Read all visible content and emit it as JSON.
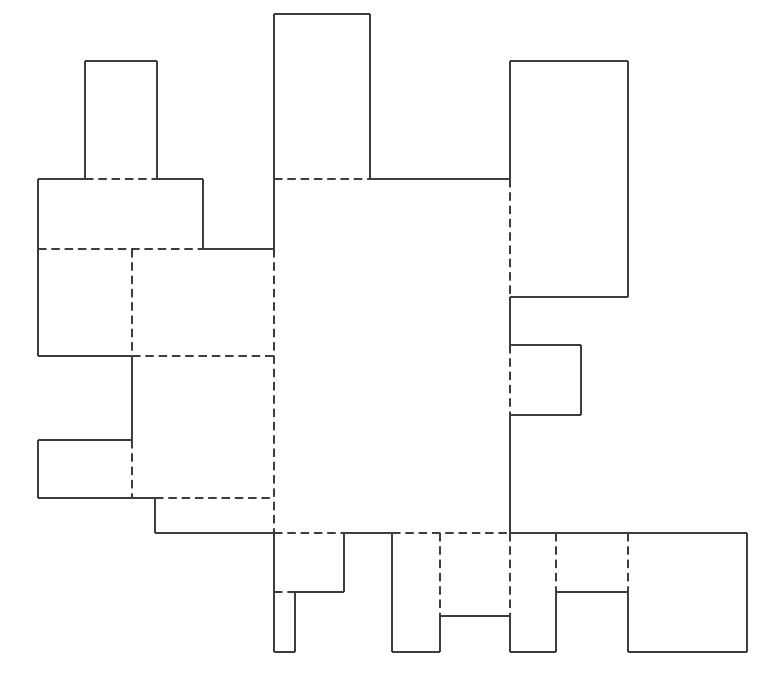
{
  "figure": {
    "title": "box-net-dieline",
    "type": "line-diagram",
    "canvas": {
      "width": 768,
      "height": 685,
      "background": "#ffffff"
    },
    "style": {
      "line_color": "#3d3d3d",
      "line_width": 2,
      "dash_pattern": "8.5 4.8"
    },
    "cut_lines": [
      [
        38,
        179,
        85,
        179
      ],
      [
        85,
        179,
        85,
        61
      ],
      [
        85,
        61,
        157,
        61
      ],
      [
        157,
        61,
        157,
        179
      ],
      [
        157,
        179,
        203,
        179
      ],
      [
        203,
        179,
        203,
        249
      ],
      [
        203,
        249,
        274,
        249
      ],
      [
        274,
        249,
        274,
        14
      ],
      [
        274,
        14,
        370,
        14
      ],
      [
        370,
        14,
        370,
        179
      ],
      [
        370,
        179,
        510,
        179
      ],
      [
        510,
        179,
        510,
        61
      ],
      [
        510,
        61,
        628,
        61
      ],
      [
        628,
        61,
        628,
        297
      ],
      [
        628,
        297,
        510,
        297
      ],
      [
        510,
        297,
        510,
        345
      ],
      [
        510,
        345,
        581,
        345
      ],
      [
        581,
        345,
        581,
        415
      ],
      [
        581,
        415,
        510,
        415
      ],
      [
        510,
        415,
        510,
        533
      ],
      [
        510,
        533,
        747,
        533
      ],
      [
        747,
        533,
        747,
        652
      ],
      [
        747,
        652,
        628,
        652
      ],
      [
        628,
        652,
        628,
        592
      ],
      [
        628,
        592,
        556,
        592
      ],
      [
        556,
        592,
        556,
        652
      ],
      [
        556,
        652,
        510,
        652
      ],
      [
        510,
        652,
        510,
        616
      ],
      [
        510,
        616,
        440,
        616
      ],
      [
        440,
        616,
        440,
        652
      ],
      [
        440,
        652,
        392,
        652
      ],
      [
        392,
        652,
        392,
        533
      ],
      [
        392,
        533,
        344,
        533
      ],
      [
        344,
        533,
        344,
        592
      ],
      [
        344,
        592,
        295,
        592
      ],
      [
        295,
        592,
        295,
        652
      ],
      [
        295,
        652,
        274,
        652
      ],
      [
        274,
        652,
        274,
        533
      ],
      [
        274,
        533,
        155,
        533
      ],
      [
        155,
        533,
        155,
        498
      ],
      [
        155,
        498,
        38,
        498
      ],
      [
        38,
        498,
        38,
        440
      ],
      [
        38,
        440,
        132,
        440
      ],
      [
        132,
        440,
        132,
        356
      ],
      [
        132,
        356,
        38,
        356
      ],
      [
        38,
        356,
        38,
        179
      ]
    ],
    "fold_lines": [
      [
        85,
        179,
        157,
        179
      ],
      [
        274,
        179,
        370,
        179
      ],
      [
        38,
        249,
        203,
        249
      ],
      [
        132,
        249,
        132,
        356
      ],
      [
        132,
        440,
        132,
        498
      ],
      [
        132,
        356,
        274,
        356
      ],
      [
        274,
        249,
        274,
        533
      ],
      [
        155,
        498,
        274,
        498
      ],
      [
        510,
        179,
        510,
        297
      ],
      [
        510,
        345,
        510,
        415
      ],
      [
        274,
        533,
        344,
        533
      ],
      [
        392,
        533,
        510,
        533
      ],
      [
        440,
        533,
        440,
        616
      ],
      [
        510,
        533,
        510,
        616
      ],
      [
        556,
        533,
        556,
        592
      ],
      [
        628,
        533,
        628,
        592
      ],
      [
        274,
        592,
        295,
        592
      ]
    ]
  }
}
